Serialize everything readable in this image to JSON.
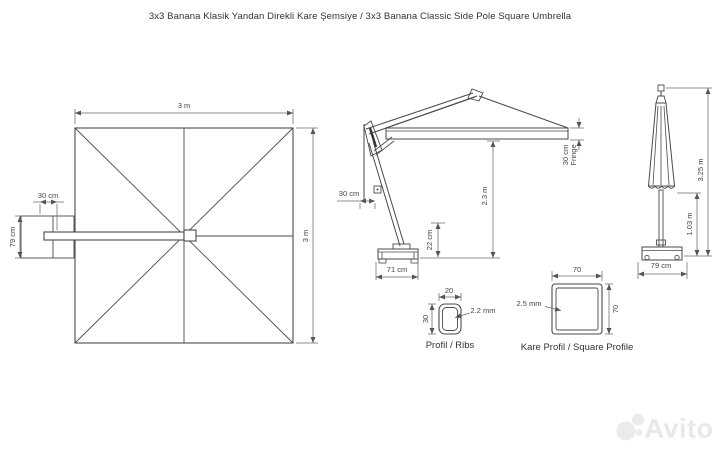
{
  "title": "3x3 Banana Klasik Yandan Direkli Kare Şemsiye / 3x3 Banana Classic Side Pole Square Umbrella",
  "top_view": {
    "width_dim": "3 m",
    "height_dim": "3 m",
    "pole_offset_dim": "30 cm",
    "base_depth_dim": "79 cm"
  },
  "side_view": {
    "pole_offset_dim": "30 cm",
    "clearance_dim": "2.3 m",
    "base_height_dim": "22 cm",
    "base_width_dim": "71 cm",
    "fringe_dim_line1": "30 cm",
    "fringe_dim_line2": "Fringe"
  },
  "closed_view": {
    "total_height_dim": "3.25 m",
    "pole_height_dim": "1.03 m",
    "base_width_dim": "79 cm"
  },
  "rib_profile": {
    "width_dim": "20",
    "height_dim": "30",
    "wall_dim": "2.2 mm",
    "label": "Profil / Ribs"
  },
  "square_profile": {
    "width_dim": "70",
    "height_dim": "70",
    "wall_dim": "2.5 mm",
    "label": "Kare Profil / Square Profile"
  },
  "watermark": {
    "text": "Avito"
  },
  "colors": {
    "object_line": "#4a4a4a",
    "dimension_line": "#6a6a6a",
    "text": "#444444",
    "watermark": "#e8e8e8"
  }
}
